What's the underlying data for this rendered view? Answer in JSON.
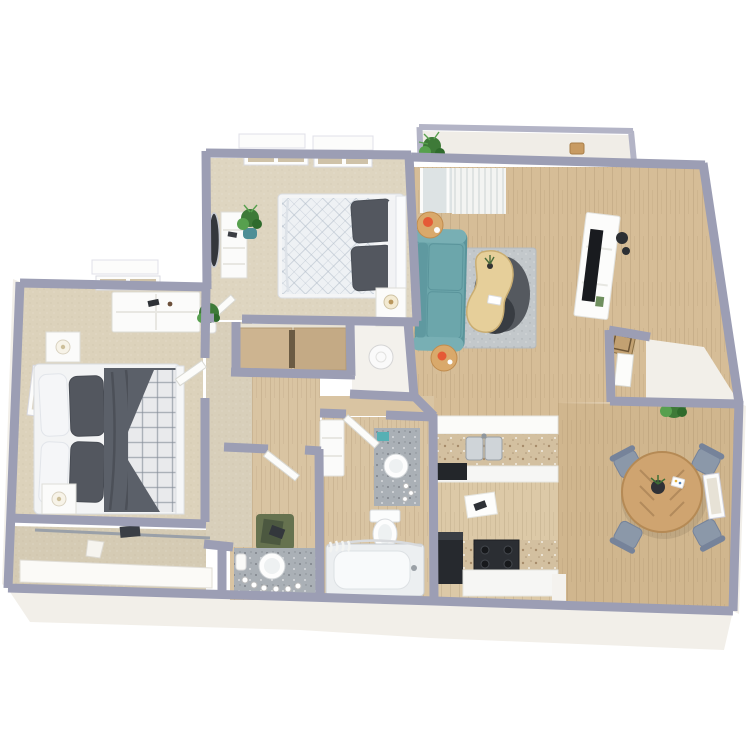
{
  "scene": {
    "kind": "3d-floorplan-render",
    "view": "top-down 3D dollhouse rendering",
    "description": "Two-bedroom apartment floor plan render with balcony, living room, dining area, kitchen, bathroom, vanity area, hallway and two closets",
    "background": "#ffffff"
  },
  "palette": {
    "wall": "#9c9eb4",
    "wall_light": "#b3b4c6",
    "white_face": "#f2efe9",
    "carpet": "#ded5c0",
    "carpet_dark": "#d5cbb4",
    "wood": "#d6bd97",
    "wood_kitchen": "#dcc9a7",
    "wood_dining": "#d0b68e",
    "wood_bath": "#d9c4a2",
    "sofa": "#6ca6ab",
    "sofa_dark": "#5a949b",
    "rug": "#c3c8cb",
    "rug_dark": "#55595f",
    "rug_darker": "#383c42",
    "coffee_table": "#e6cf9a",
    "side_table": "#d9a96b",
    "accent": "#e55a36",
    "console": "#fcfcfb",
    "tv": "#191b1f",
    "chair": "#8b98a9",
    "dining_table": "#cfa470",
    "bed_dark": "#5b6069",
    "pillow_dark": "#53575f",
    "bed_light": "#eef1f4",
    "granite_gray": "#aab0b6",
    "granite_tan": "#d3c0a0",
    "appliance": "#26292e",
    "plant": "#3e7a38",
    "plant_light": "#57a04e",
    "teal_pot": "#4e8e96",
    "closet_door": "#cdb490",
    "green_rug": "#66724f",
    "frame_white": "#fcfcfb",
    "steel": "#cfd4d8"
  },
  "rooms": [
    {
      "id": "balcony",
      "label": "Balcony",
      "floor": "white",
      "furniture": [
        "potted plant",
        "wood stool"
      ]
    },
    {
      "id": "bedroom-2",
      "label": "Bedroom 2",
      "floor": "carpet",
      "furniture": [
        "bed with white quilt",
        "two dark gray pillows",
        "nightstand with lamp",
        "dresser",
        "standing oval mirror",
        "potted plant in teal pot",
        "two windows"
      ]
    },
    {
      "id": "living-room",
      "label": "Living Room",
      "floor": "wood",
      "furniture": [
        "teal sofa",
        "gray area rug",
        "dark round rug",
        "kidney-shaped wood coffee table with small plant",
        "two round side tables",
        "orange teapot",
        "orange mug",
        "white media console",
        "flat tv",
        "wall speakers",
        "sliding glass door with vertical blinds",
        "entry door",
        "doormat"
      ]
    },
    {
      "id": "dining-area",
      "label": "Dining Area",
      "floor": "wood",
      "furniture": [
        "round wood dining table",
        "four gray chairs",
        "dark centerpiece with greenery",
        "white place card",
        "corner potted plant",
        "white wall frame"
      ]
    },
    {
      "id": "kitchen",
      "label": "Kitchen",
      "floor": "wood",
      "furniture": [
        "granite counter with double stainless sink",
        "dishwasher",
        "black range stove",
        "black refrigerator",
        "white floor mat"
      ]
    },
    {
      "id": "bathroom",
      "label": "Bathroom",
      "floor": "wood",
      "furniture": [
        "granite vanity with round sink and toiletries",
        "toilet",
        "bathtub with curved curtain rod",
        "white storage cabinet",
        "door"
      ]
    },
    {
      "id": "vanity-area",
      "label": "Vanity Area",
      "floor": "wood",
      "furniture": [
        "granite vanity with round sink",
        "perfume bottles",
        "green bath rug",
        "door"
      ]
    },
    {
      "id": "hallway",
      "label": "Hallway",
      "floor": "carpet",
      "furniture": []
    },
    {
      "id": "master-bedroom",
      "label": "Master Bedroom",
      "floor": "carpet",
      "furniture": [
        "bed with dark gray duvet and white plaid blanket",
        "two nightstands with lamps",
        "long white dresser with trinkets",
        "potted plant",
        "white wall art",
        "window",
        "door"
      ]
    },
    {
      "id": "master-closet",
      "label": "Master Closet",
      "floor": "carpet",
      "furniture": [
        "closet rod",
        "hanging clothes",
        "white base shelf",
        "white bag"
      ]
    },
    {
      "id": "bedroom-2-closet",
      "label": "Bedroom 2 Closet",
      "floor": "wood",
      "furniture": [
        "tan sliding doors"
      ]
    },
    {
      "id": "utility-closet",
      "label": "Utility Closet",
      "floor": "white",
      "furniture": [
        "water heater"
      ]
    },
    {
      "id": "entry",
      "label": "Entry Alcove",
      "floor": "white",
      "furniture": []
    }
  ]
}
